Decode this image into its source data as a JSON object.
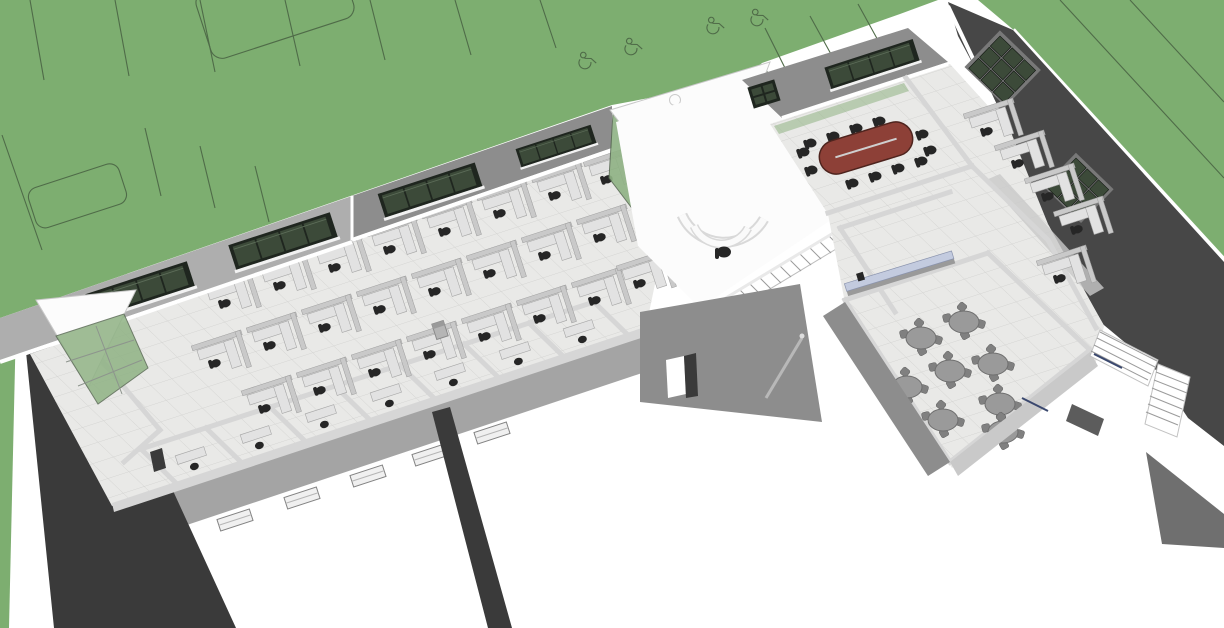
{
  "scene": {
    "description": "3D aerial cutaway rendering of an L-shaped single-story office building on a green lawn with parking striping; roofless view exposes furnished interior",
    "view": "axonometric aerial, building axis rotated about -18 degrees",
    "software_style": "architectural CAD massing render, no on-screen text"
  },
  "palette": {
    "paper": "#ffffff",
    "grass": "#7dae70",
    "grassLine": "#4f6b48",
    "charcoal": "#474747",
    "charcoalDark": "#3a3a3a",
    "wedgeGray": "#6f6f6f",
    "facadeMid": "#8d8d8d",
    "facadeLight": "#aeaeae",
    "facadeSouth": "#a4a4a4",
    "facadeLit": "#c9c9c9",
    "wallCut": "#d6d6d6",
    "floor": "#e9e9e7",
    "tileLine": "#d3d3d1",
    "lobbyFloor": "#fcfcfc",
    "glassDark": "#3c4a39",
    "glassFrame": "#1f261f",
    "glassGreen": "#8fb284",
    "mullion": "#8d948d",
    "desk": "#e2e2e2",
    "deskEdge": "#a6a6a6",
    "partition": "#c9c9c9",
    "chairDark": "#262626",
    "confTable": "#8d4037",
    "confTableEdge": "#4e241e",
    "roundTable": "#9a9a9a",
    "breakChair": "#808080",
    "counterTop": "#c3cbdf",
    "stepLine": "#9b9b9b",
    "accentBlue": "#3a486e"
  },
  "site": {
    "lawn_areas": 3,
    "parking_stall_lines": 13,
    "accessible_parking_symbols": 4,
    "curb_island_outlines": 2,
    "lawn_contour_lines": 3,
    "sidewalk_color": "#ffffff"
  },
  "building": {
    "left_wing_open_office": {
      "workstations": 24,
      "workstation_chairs": 24,
      "private_offices": 7,
      "private_office_desks": 7,
      "copier_units": 1,
      "ribbon_windows": 4,
      "clerestory_windows": 5,
      "west_entry": {
        "canopy": "white triangular",
        "curtain_wall": "green glass"
      }
    },
    "lobby": {
      "reception_desk": "curved double-arc counter",
      "reception_chairs": 1,
      "interior_stair_steps": 15,
      "atrium": {
        "canopy": "white triangular",
        "curtain_wall": "green glass with gray mullions",
        "roof_opening": "circular cutout"
      }
    },
    "right_wing": {
      "conference_room": {
        "table_shape": "oval racetrack",
        "table_color": "#8d4037",
        "chairs": 12,
        "ribbon_windows": 1,
        "small_windows": 1
      },
      "window_workstations": 5,
      "kitchenette": {
        "counters": 1,
        "counter_top_color": "#c3cbdf",
        "appliances": 1
      },
      "break_room": {
        "round_tables": 8,
        "chairs_per_table": 4
      },
      "east_facade_window_grids": 2,
      "exterior_stair_flights": 2
    }
  }
}
